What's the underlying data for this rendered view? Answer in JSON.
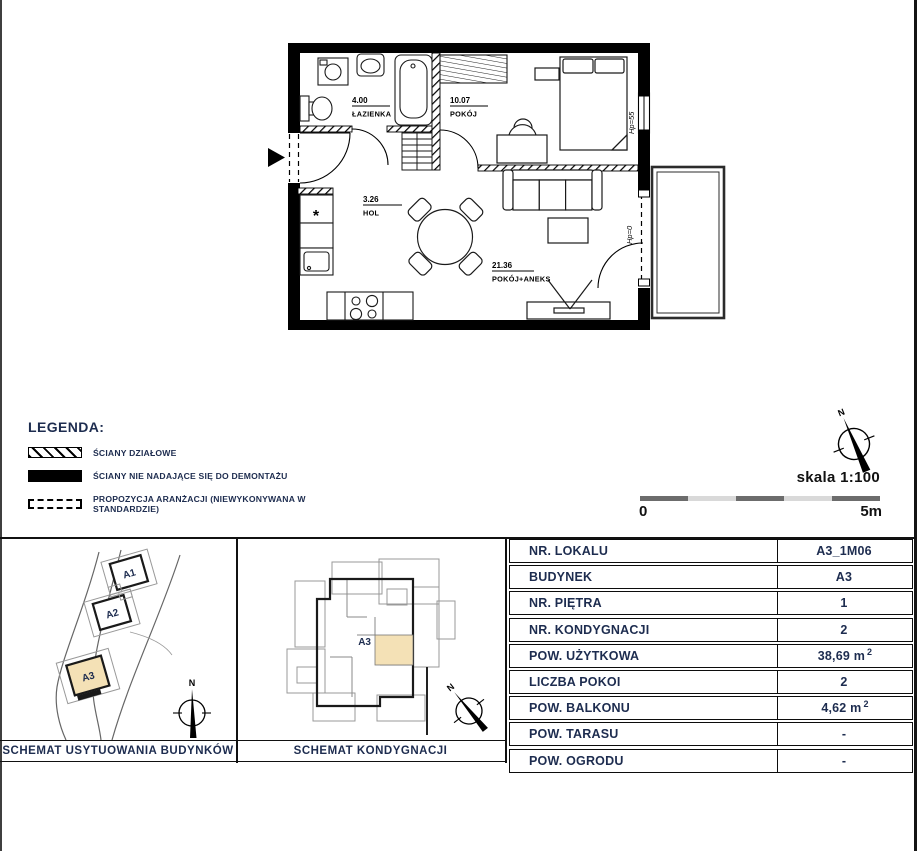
{
  "floor_plan": {
    "rooms": [
      {
        "area": "4.00",
        "name": "ŁAZIENKA"
      },
      {
        "area": "10.07",
        "name": "POKÓJ"
      },
      {
        "area": "3.26",
        "name": "HOL"
      },
      {
        "area": "21.36",
        "name": "POKÓJ+ANEKS"
      }
    ],
    "annotations": {
      "window_hp": "Hp=55",
      "door_hp": "Hp=0",
      "fridge_symbol": "*"
    }
  },
  "legend": {
    "title": "LEGENDA:",
    "items": [
      {
        "label": "ŚCIANY DZIAŁOWE"
      },
      {
        "label": "ŚCIANY NIE NADAJĄCE SIĘ DO DEMONTAŻU"
      },
      {
        "label": "PROPOZYCJA ARANŻACJI (NIEWYKONYWANA W STANDARDZIE)"
      }
    ]
  },
  "scale": {
    "label": "skala 1:100",
    "start": "0",
    "end": "5m"
  },
  "compass": {
    "north_label": "N"
  },
  "site_plan": {
    "caption": "SCHEMAT  USYTUOWANIA BUDYNKÓW",
    "north_label": "N",
    "buildings": [
      {
        "label": "A1",
        "highlighted": false
      },
      {
        "label": "A2",
        "highlighted": false
      },
      {
        "label": "A3",
        "highlighted": true
      }
    ]
  },
  "floor_schematic": {
    "caption": "SCHEMAT  KONDYGNACJI",
    "building_label": "A3",
    "north_label": "N"
  },
  "table": {
    "rows": [
      {
        "label": "NR. LOKALU",
        "value": "A3_1M06",
        "sup": ""
      },
      {
        "label": "BUDYNEK",
        "value": "A3",
        "sup": ""
      },
      {
        "label": "NR. PIĘTRA",
        "value": "1",
        "sup": ""
      },
      {
        "label": "NR. KONDYGNACJI",
        "value": "2",
        "sup": ""
      },
      {
        "label": "POW. UŻYTKOWA",
        "value": "38,69 m",
        "sup": "2"
      },
      {
        "label": "LICZBA POKOI",
        "value": "2",
        "sup": ""
      },
      {
        "label": "POW. BALKONU",
        "value": "4,62 m",
        "sup": "2"
      },
      {
        "label": "POW. TARASU",
        "value": "-",
        "sup": ""
      },
      {
        "label": "POW. OGRODU",
        "value": "-",
        "sup": ""
      }
    ]
  },
  "colors": {
    "navy": "#1d2c4f",
    "highlight": "#f4e1b6",
    "wall": "#000000",
    "schematic_gray": "#999999"
  }
}
